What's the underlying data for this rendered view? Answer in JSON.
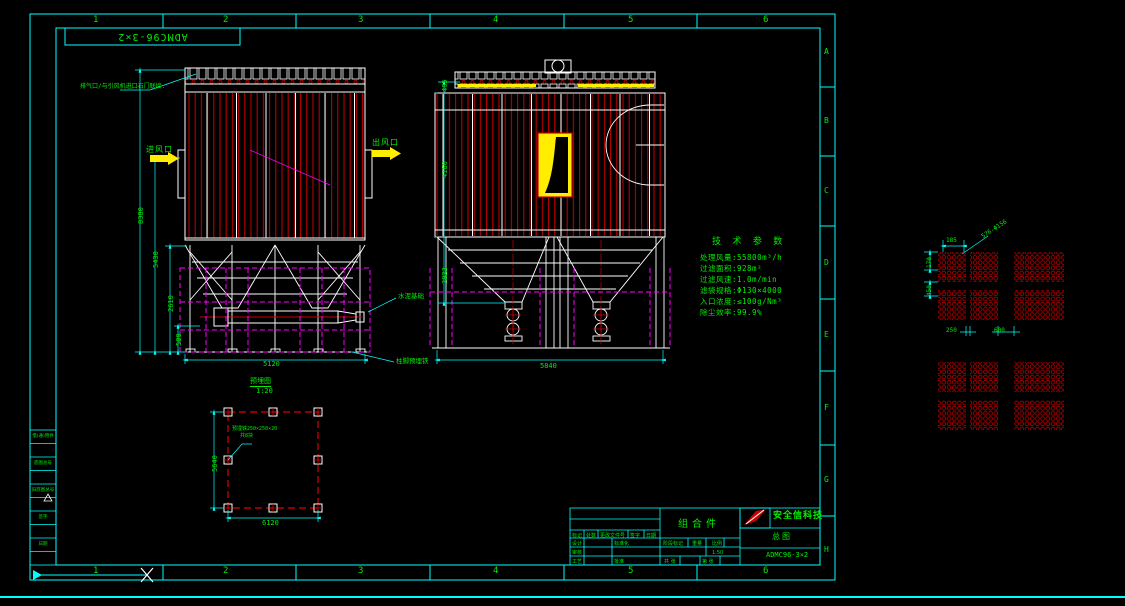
{
  "sheet": {
    "code": "ADMC96-3×2"
  },
  "grid": {
    "top": [
      "1",
      "2",
      "3",
      "4",
      "5",
      "6"
    ],
    "bottom": [
      "1",
      "2",
      "3",
      "4",
      "5",
      "6"
    ],
    "right": [
      "A",
      "B",
      "C",
      "D",
      "E",
      "F",
      "G",
      "H"
    ]
  },
  "front_view": {
    "exhaust_note": "排气口/与引风机进口石门联接.",
    "inlet_label": "进风口",
    "outlet_label": "出风口",
    "foundation_label": "水泥基础",
    "anchor_label": "柱脚预埋铁",
    "dims": {
      "total_height": "8380",
      "inlet_height": "5430",
      "hopper_height": "2610",
      "base": "500",
      "width": "5120"
    }
  },
  "side_view": {
    "dims": {
      "top": "405",
      "body": "4160",
      "hopper": "2023",
      "width": "5840"
    }
  },
  "plan_view": {
    "title": "预埋图",
    "scale": "1:20",
    "note_line1": "预埋铁250×250×20",
    "note_line2": "共8块",
    "dims": {
      "height": "5640",
      "width": "6120"
    }
  },
  "tech_params": {
    "title": "技 术 参 数",
    "items": [
      "处理风量:55800m³/h",
      "过滤面积:928m²",
      "过滤风速:1.0m/min",
      "滤袋规格:Φ130×4000",
      "入口浓度:≤100g/Nm³",
      "除尘效率:99.9%"
    ]
  },
  "tube_sheet": {
    "holes_note": "576-Φ156",
    "dims": {
      "pitch_h": "185",
      "pitch_v": "170",
      "gap_v": "450",
      "gap_1": "250",
      "gap_2": "600"
    }
  },
  "title_block": {
    "part_name": "组合件",
    "company": "安全信科技",
    "doc_type": "总图",
    "drawing_no": "ADMC96-3×2",
    "rev_headers": [
      "标记",
      "处数",
      "更改文件号",
      "签字",
      "日期"
    ],
    "roles": {
      "design": "设计",
      "standard": "标准化",
      "audit": "审核",
      "process": "工艺",
      "approve": "批准"
    },
    "stage": "阶段标记",
    "weight": "重量",
    "scale_label": "比例",
    "scale_value": "1:50",
    "sheets": "共 张",
    "sheet_no": "第 张"
  },
  "left_strip": {
    "rows": [
      "借(通)用件登记",
      "",
      "底图总号",
      "",
      "旧底图总号",
      "",
      "签字",
      "",
      "日期",
      ""
    ]
  }
}
